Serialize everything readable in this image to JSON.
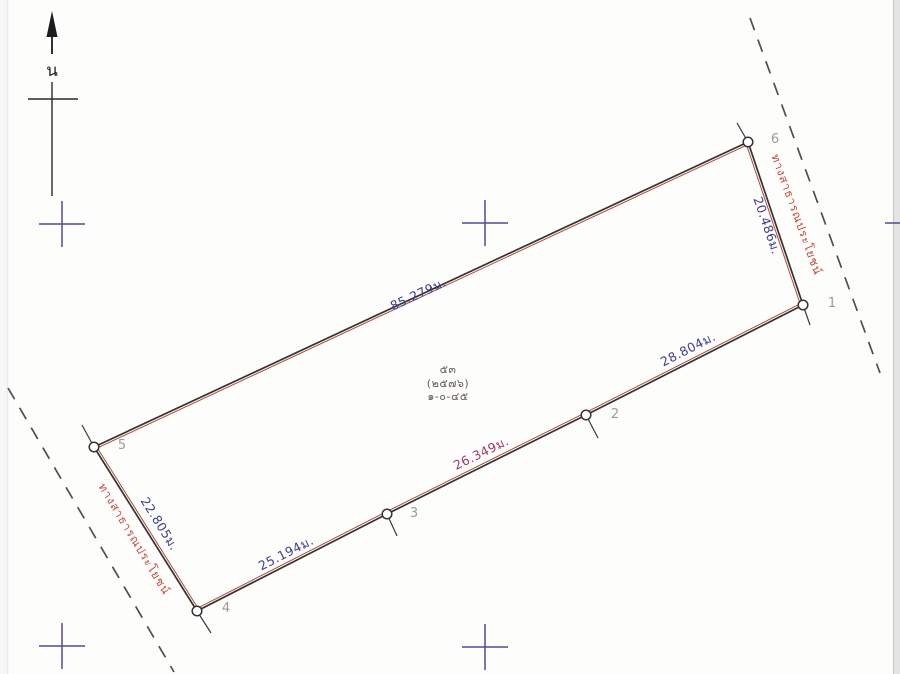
{
  "canvas": {
    "width": 900,
    "height": 674
  },
  "colors": {
    "background": "#fdfdfc",
    "boundary_black": "#333333",
    "boundary_red": "#b04a3a",
    "dimension_blue": "#3f3f93",
    "dimension_magenta": "#a23a64",
    "road_red": "#c24b3c",
    "road_line": "#4f4f4f",
    "vertex_label_gray": "#9b9b9b",
    "grid_cross_blue": "#4d4d96",
    "north_black": "#1c1c1c",
    "center_text": "#675f58",
    "page_edge_strip": "#e4e4e4",
    "page_edge_line": "#c6c6c6",
    "left_edge_line": "#ebebeb"
  },
  "north": {
    "label": "น"
  },
  "grid_crosses": [
    {
      "x": 62,
      "y": 224
    },
    {
      "x": 485,
      "y": 223
    },
    {
      "x": 62,
      "y": 646
    },
    {
      "x": 485,
      "y": 647
    },
    {
      "x": 908,
      "y": 223
    }
  ],
  "roads": [
    {
      "name": "ทางสาธารณประโยชน์",
      "dash": {
        "x1": 750,
        "y1": 18,
        "x2": 880,
        "y2": 373
      },
      "label_x": 793,
      "label_y": 216,
      "label_rotation": 70
    },
    {
      "name": "ทางสาธารณประโยชน์",
      "dash": {
        "x1": 8,
        "y1": 388,
        "x2": 174,
        "y2": 672
      },
      "label_x": 131,
      "label_y": 541,
      "label_rotation": 59
    }
  ],
  "parcel": {
    "vertices": [
      {
        "id": "1",
        "x": 803,
        "y": 305,
        "label_x": 832,
        "label_y": 307
      },
      {
        "id": "2",
        "x": 586,
        "y": 415,
        "label_x": 615,
        "label_y": 418
      },
      {
        "id": "3",
        "x": 387,
        "y": 514,
        "label_x": 414,
        "label_y": 517
      },
      {
        "id": "4",
        "x": 197,
        "y": 611,
        "label_x": 226,
        "label_y": 612
      },
      {
        "id": "5",
        "x": 94,
        "y": 447,
        "label_x": 122,
        "label_y": 449
      },
      {
        "id": "6",
        "x": 748,
        "y": 142,
        "label_x": 775,
        "label_y": 143
      }
    ],
    "edges": [
      {
        "from": "5",
        "to": "6",
        "length_label": "85.279ม.",
        "ink": "blue",
        "label_x": 420,
        "label_y": 298,
        "label_rotation": -25
      },
      {
        "from": "6",
        "to": "1",
        "length_label": "20.486ม.",
        "ink": "blue",
        "label_x": 763,
        "label_y": 227,
        "label_rotation": 71
      },
      {
        "from": "1",
        "to": "2",
        "length_label": "28.804ม.",
        "ink": "blue",
        "label_x": 690,
        "label_y": 353,
        "label_rotation": -27
      },
      {
        "from": "2",
        "to": "3",
        "length_label": "26.349ม.",
        "ink": "magenta",
        "label_x": 483,
        "label_y": 457,
        "label_rotation": -26
      },
      {
        "from": "3",
        "to": "4",
        "length_label": "25.194ม.",
        "ink": "blue",
        "label_x": 288,
        "label_y": 557,
        "label_rotation": -27
      },
      {
        "from": "4",
        "to": "5",
        "length_label": "22.805ม.",
        "ink": "blue",
        "label_x": 156,
        "label_y": 526,
        "label_rotation": 58
      }
    ],
    "ticks": [
      {
        "x1": 748,
        "y1": 142,
        "x2": 737,
        "y2": 123
      },
      {
        "x1": 803,
        "y1": 305,
        "x2": 810,
        "y2": 325
      },
      {
        "x1": 586,
        "y1": 415,
        "x2": 598,
        "y2": 438
      },
      {
        "x1": 387,
        "y1": 514,
        "x2": 397,
        "y2": 536
      },
      {
        "x1": 197,
        "y1": 611,
        "x2": 211,
        "y2": 633
      },
      {
        "x1": 94,
        "y1": 447,
        "x2": 82,
        "y2": 425
      }
    ]
  },
  "center_label": {
    "line1": "๕๓",
    "line2": "(๒๕๗๖)",
    "line3": "๑-๐-๔๕"
  }
}
